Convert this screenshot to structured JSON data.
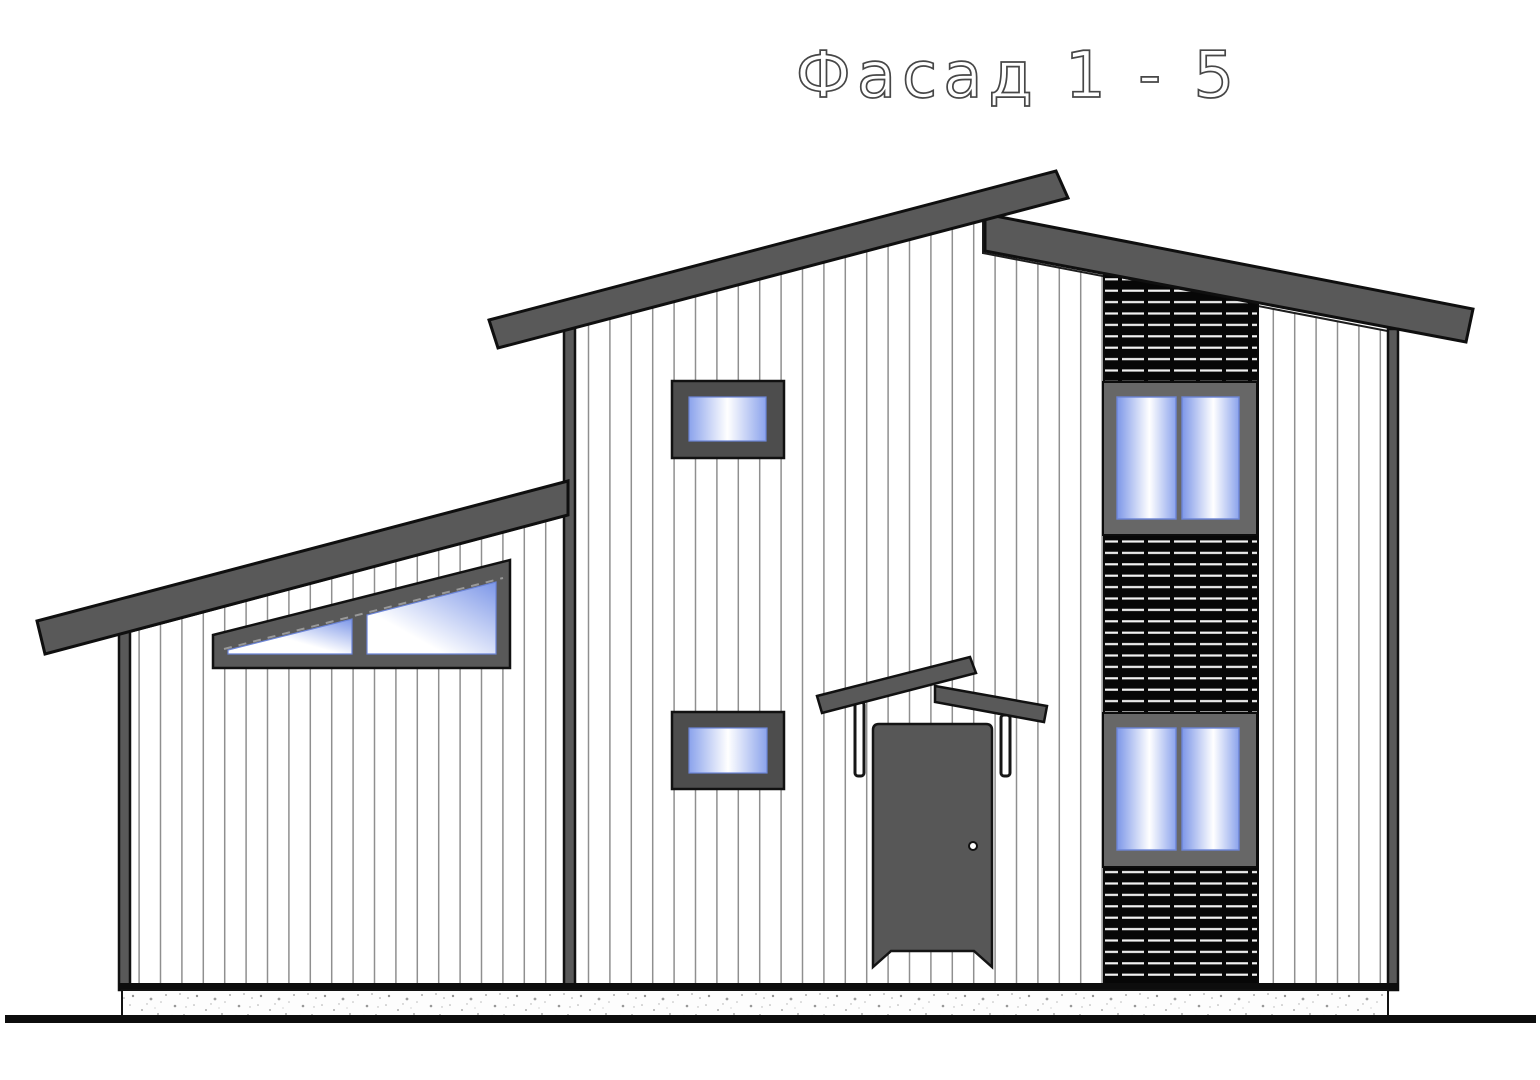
{
  "drawing": {
    "title": "Фасад 1 - 5",
    "kind": "house facade elevation drawing"
  },
  "colors": {
    "background": "#ffffff",
    "roof_gray": "#595959",
    "door_gray": "#575757",
    "window_frame_dark": "#4d4d4d",
    "window_frame_medium": "#676767",
    "glass_blue": "#8ba3ec",
    "glass_blue_deep": "#7d97e8",
    "glass_edge": "#6b84d6",
    "glass_white": "#ffffff",
    "siding_line": "#8f8f8f",
    "louver_black": "#070707",
    "louver_line": "#f2f2f2",
    "foundation_speck": "#777777",
    "ground_black": "#0d0d0d",
    "title_ink": "#474747",
    "support_white": "#ffffff"
  }
}
